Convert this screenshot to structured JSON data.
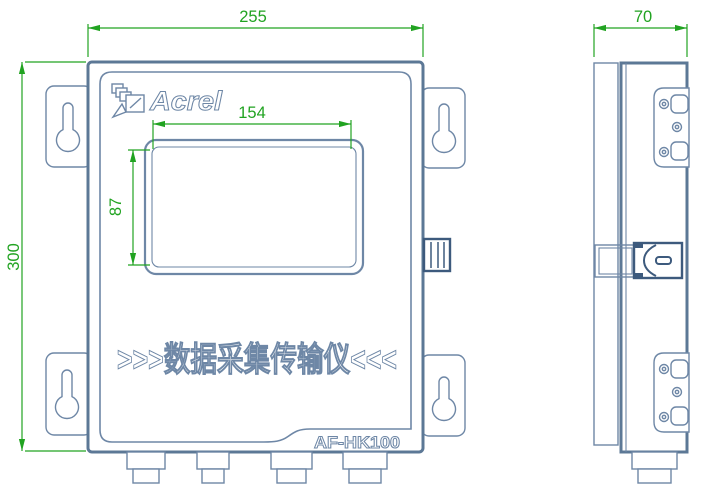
{
  "front_view": {
    "brand": "Acrel",
    "banner": ">>>数据采集传输仪<<<",
    "model": "AF-HK100"
  },
  "dimensions": {
    "overall_width": "255",
    "overall_height": "300",
    "depth": "70",
    "screen_width": "154",
    "screen_height": "87"
  },
  "icons": {
    "acrel_logo": "layered-squares-arrow",
    "keyhole": "keyhole-mounting-slot",
    "screw": "screw-head"
  },
  "colors": {
    "line": "#6e87a6",
    "line_heavy": "#5c7896",
    "line_dark": "#3d5a7d",
    "dimension": "#21a321",
    "background": "#ffffff"
  }
}
